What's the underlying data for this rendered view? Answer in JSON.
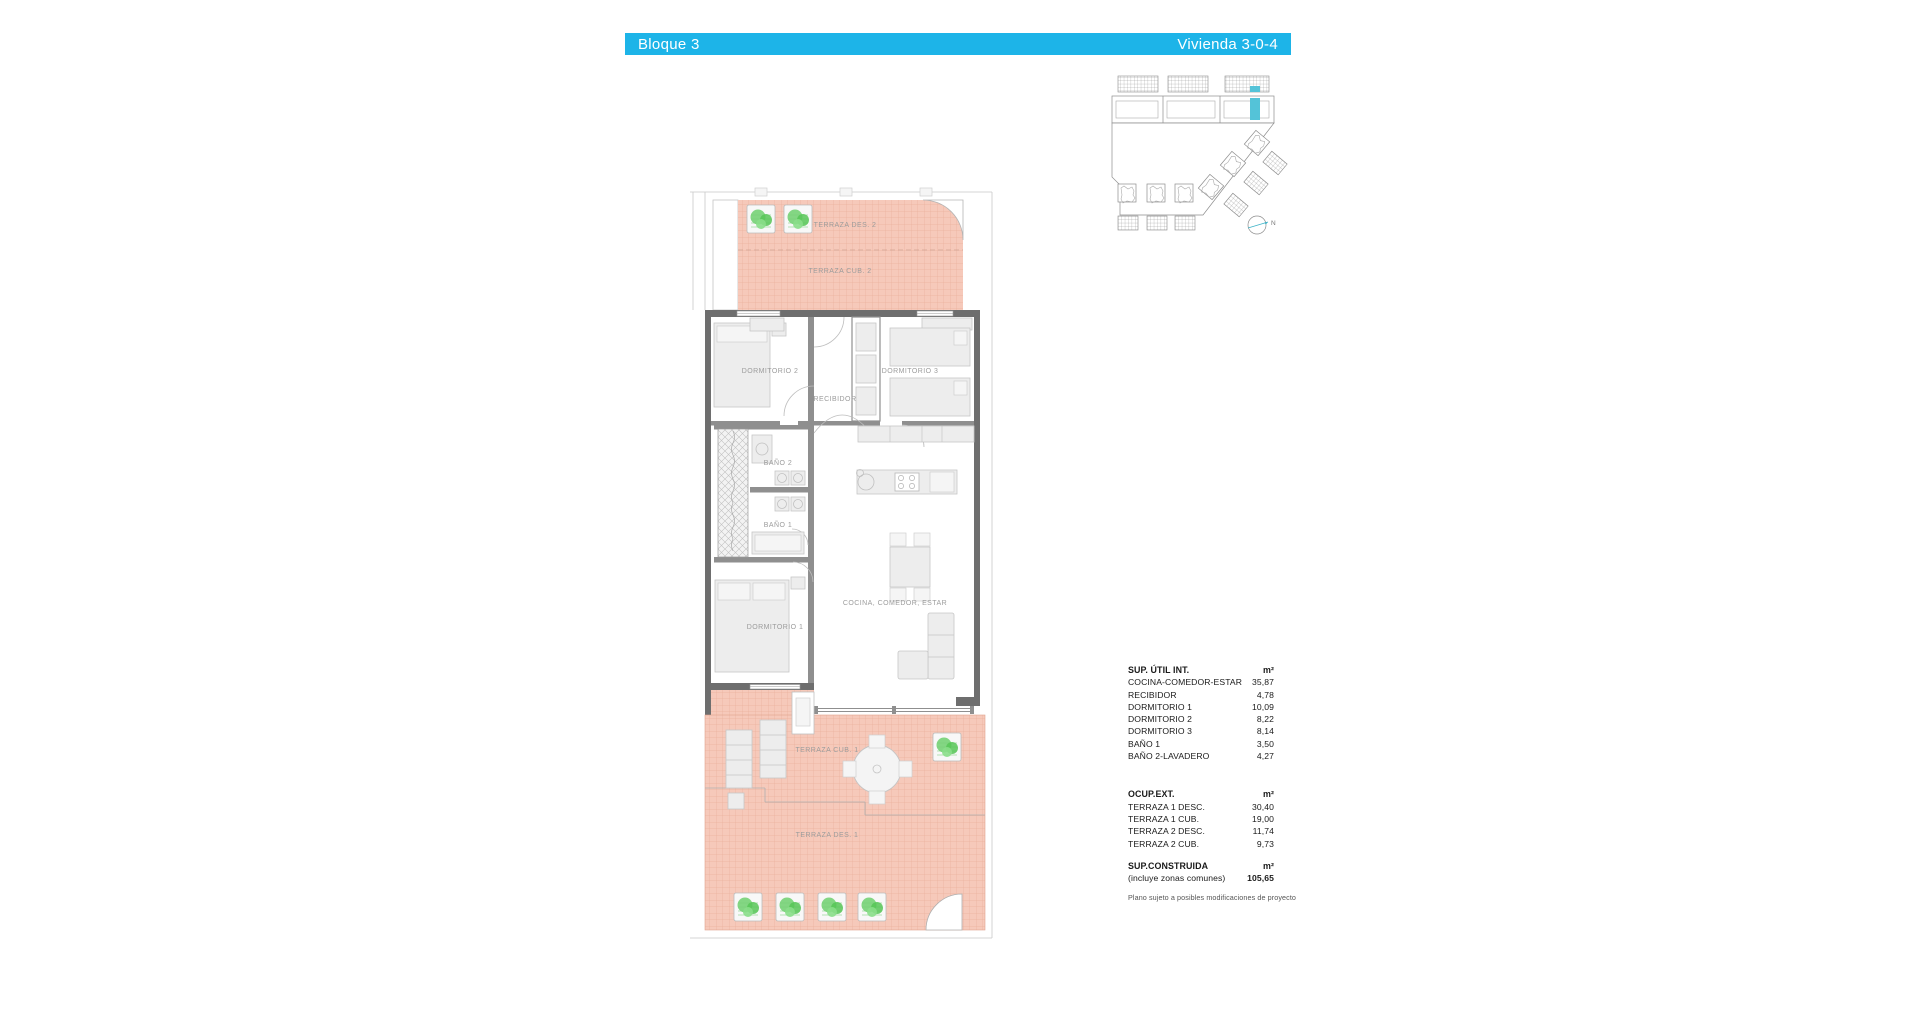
{
  "header": {
    "block_label": "Bloque 3",
    "unit_label": "Vivienda 3-0-4"
  },
  "colors": {
    "accent": "#1db4e8",
    "accent_light": "#54c3d8",
    "terrace": "#f6c9ba",
    "terrace_line": "#eab19d",
    "plant": "#76d276",
    "wall": "#6e6e6e",
    "wall_light": "#8f8f8f",
    "furniture": "#ededed",
    "furniture_line": "#c6c6c6",
    "label_text": "#9c9c9c",
    "table_text": "#1a1a1a",
    "note_text": "#555555"
  },
  "floor_plan": {
    "rooms": {
      "terraza_des_2": "TERRAZA DES. 2",
      "terraza_cub_2": "TERRAZA CUB. 2",
      "dormitorio_2": "DORMITORIO 2",
      "dormitorio_3": "DORMITORIO 3",
      "recibidor": "RECIBIDOR",
      "bano_2": "BAÑO 2",
      "bano_1": "BAÑO 1",
      "dormitorio_1": "DORMITORIO 1",
      "cocina": "COCINA, COMEDOR, ESTAR",
      "terraza_cub_1": "TERRAZA CUB. 1",
      "terraza_des_1": "TERRAZA DES. 1"
    }
  },
  "site_plan": {
    "north_label": "N"
  },
  "tables": {
    "sup_util": {
      "title": "SUP. ÚTIL INT.",
      "unit": "m²",
      "rows": [
        {
          "label": "COCINA-COMEDOR-ESTAR",
          "value": "35,87"
        },
        {
          "label": "RECIBIDOR",
          "value": "4,78"
        },
        {
          "label": "DORMITORIO 1",
          "value": "10,09"
        },
        {
          "label": "DORMITORIO 2",
          "value": "8,22"
        },
        {
          "label": "DORMITORIO 3",
          "value": "8,14"
        },
        {
          "label": "BAÑO 1",
          "value": "3,50"
        },
        {
          "label": "BAÑO 2-LAVADERO",
          "value": "4,27"
        }
      ]
    },
    "ocup_ext": {
      "title": "OCUP.EXT.",
      "unit": "m²",
      "rows": [
        {
          "label": "TERRAZA 1 DESC.",
          "value": "30,40"
        },
        {
          "label": "TERRAZA 1 CUB.",
          "value": "19,00"
        },
        {
          "label": "TERRAZA 2 DESC.",
          "value": "11,74"
        },
        {
          "label": "TERRAZA 2 CUB.",
          "value": "9,73"
        }
      ]
    },
    "sup_construida": {
      "title": "SUP.CONSTRUIDA",
      "unit": "m²",
      "subtitle": "(incluye zonas comunes)",
      "value": "105,65"
    }
  },
  "footer_note": "Plano sujeto a posibles modificaciones de proyecto"
}
